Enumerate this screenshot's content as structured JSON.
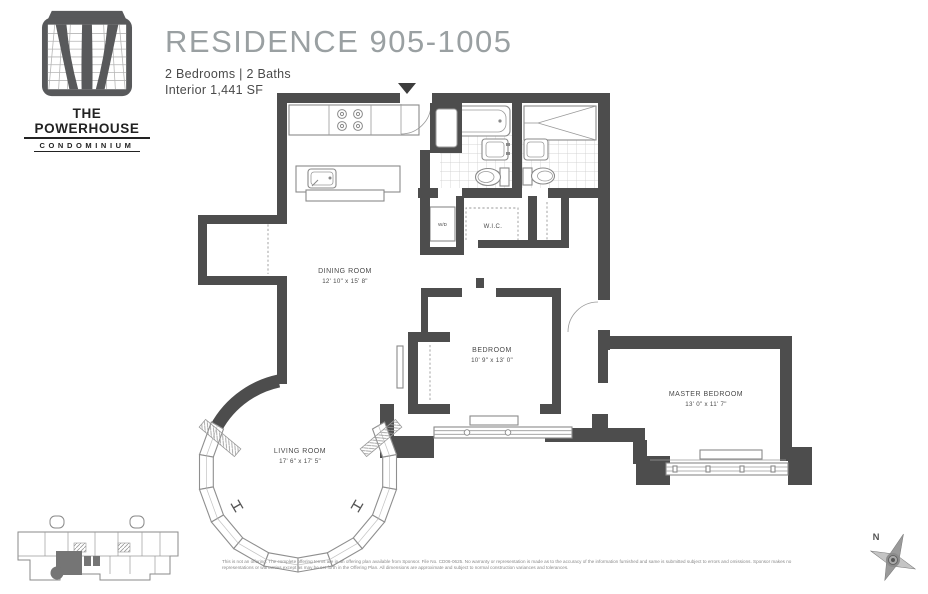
{
  "header": {
    "logo_line1": "THE POWERHOUSE",
    "logo_line2": "CONDOMINIUM",
    "title": "RESIDENCE 905-1005",
    "subtitle": "2 Bedrooms  |  2 Baths",
    "interior": "Interior 1,441 SF"
  },
  "floorplan": {
    "rooms": [
      {
        "name": "DINING ROOM",
        "dims": "12' 10\" x 15' 8\""
      },
      {
        "name": "LIVING ROOM",
        "dims": "17' 6\" x 17' 5\""
      },
      {
        "name": "BEDROOM",
        "dims": "10' 9\" x 13' 0\""
      },
      {
        "name": "MASTER BEDROOM",
        "dims": "13' 0\" x 11' 7\""
      }
    ],
    "labels": {
      "wic": "W.I.C.",
      "wd": "W/D"
    }
  },
  "compass": {
    "north": "N"
  },
  "footer": {
    "disclaimer1": "This is not an offering. The complete offering terms are in an offering plan available from Sponsor. File No. CD06-0625. No warranty or representation is made as to the accuracy of the information furnished and same is submitted subject to errors and omissions. Sponsor makes no",
    "disclaimer2": "representations or warranties except as may be set forth in the Offering Plan. All dimensions are approximate and subject to normal construction variances and tolerances."
  },
  "colors": {
    "wall": "#4d4d4d",
    "title_gray": "#9aa0a2",
    "fixture_gray": "#8a8a8a"
  }
}
